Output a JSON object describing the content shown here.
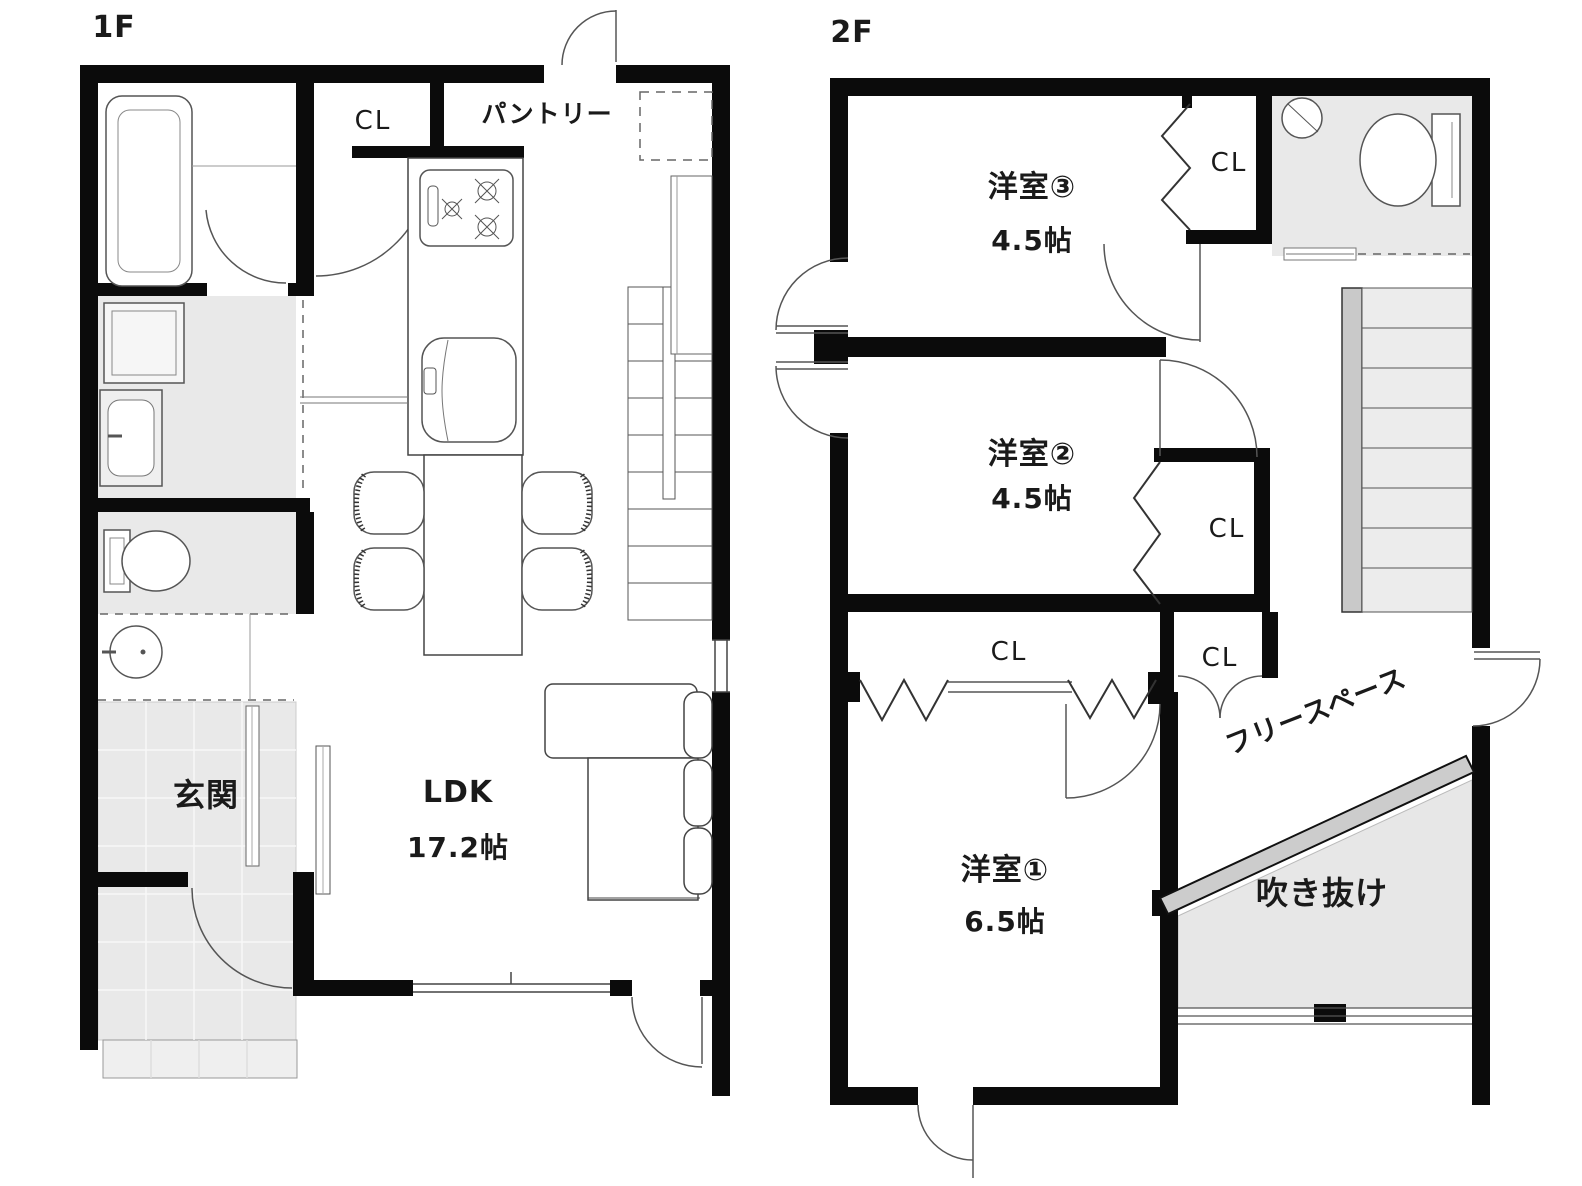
{
  "floor1": {
    "label": "1F",
    "closet_label": "CL",
    "pantry_label": "パントリー",
    "entrance_label": "玄関",
    "ldk_label": "LDK",
    "ldk_size": "17.2帖"
  },
  "floor2": {
    "label": "2F",
    "room3_label": "洋室③",
    "room3_size": "4.5帖",
    "room3_closet_label": "CL",
    "room2_label": "洋室②",
    "room2_size": "4.5帖",
    "room2_closet_label": "CL",
    "hall_closet_label": "CL",
    "hall_closet2_label": "CL",
    "room1_label": "洋室①",
    "room1_size": "6.5帖",
    "free_space_label": "フリースペース",
    "void_label": "吹き抜け"
  },
  "colors": {
    "wall": "#0b0b0b",
    "floor_gray": "#e9e9e9",
    "void_gray": "#e7e7e7",
    "railing_gray": "#cccccc",
    "stair_tread": "#ececec",
    "line": "#555555",
    "text": "#1a1a1a",
    "background": "#ffffff"
  }
}
